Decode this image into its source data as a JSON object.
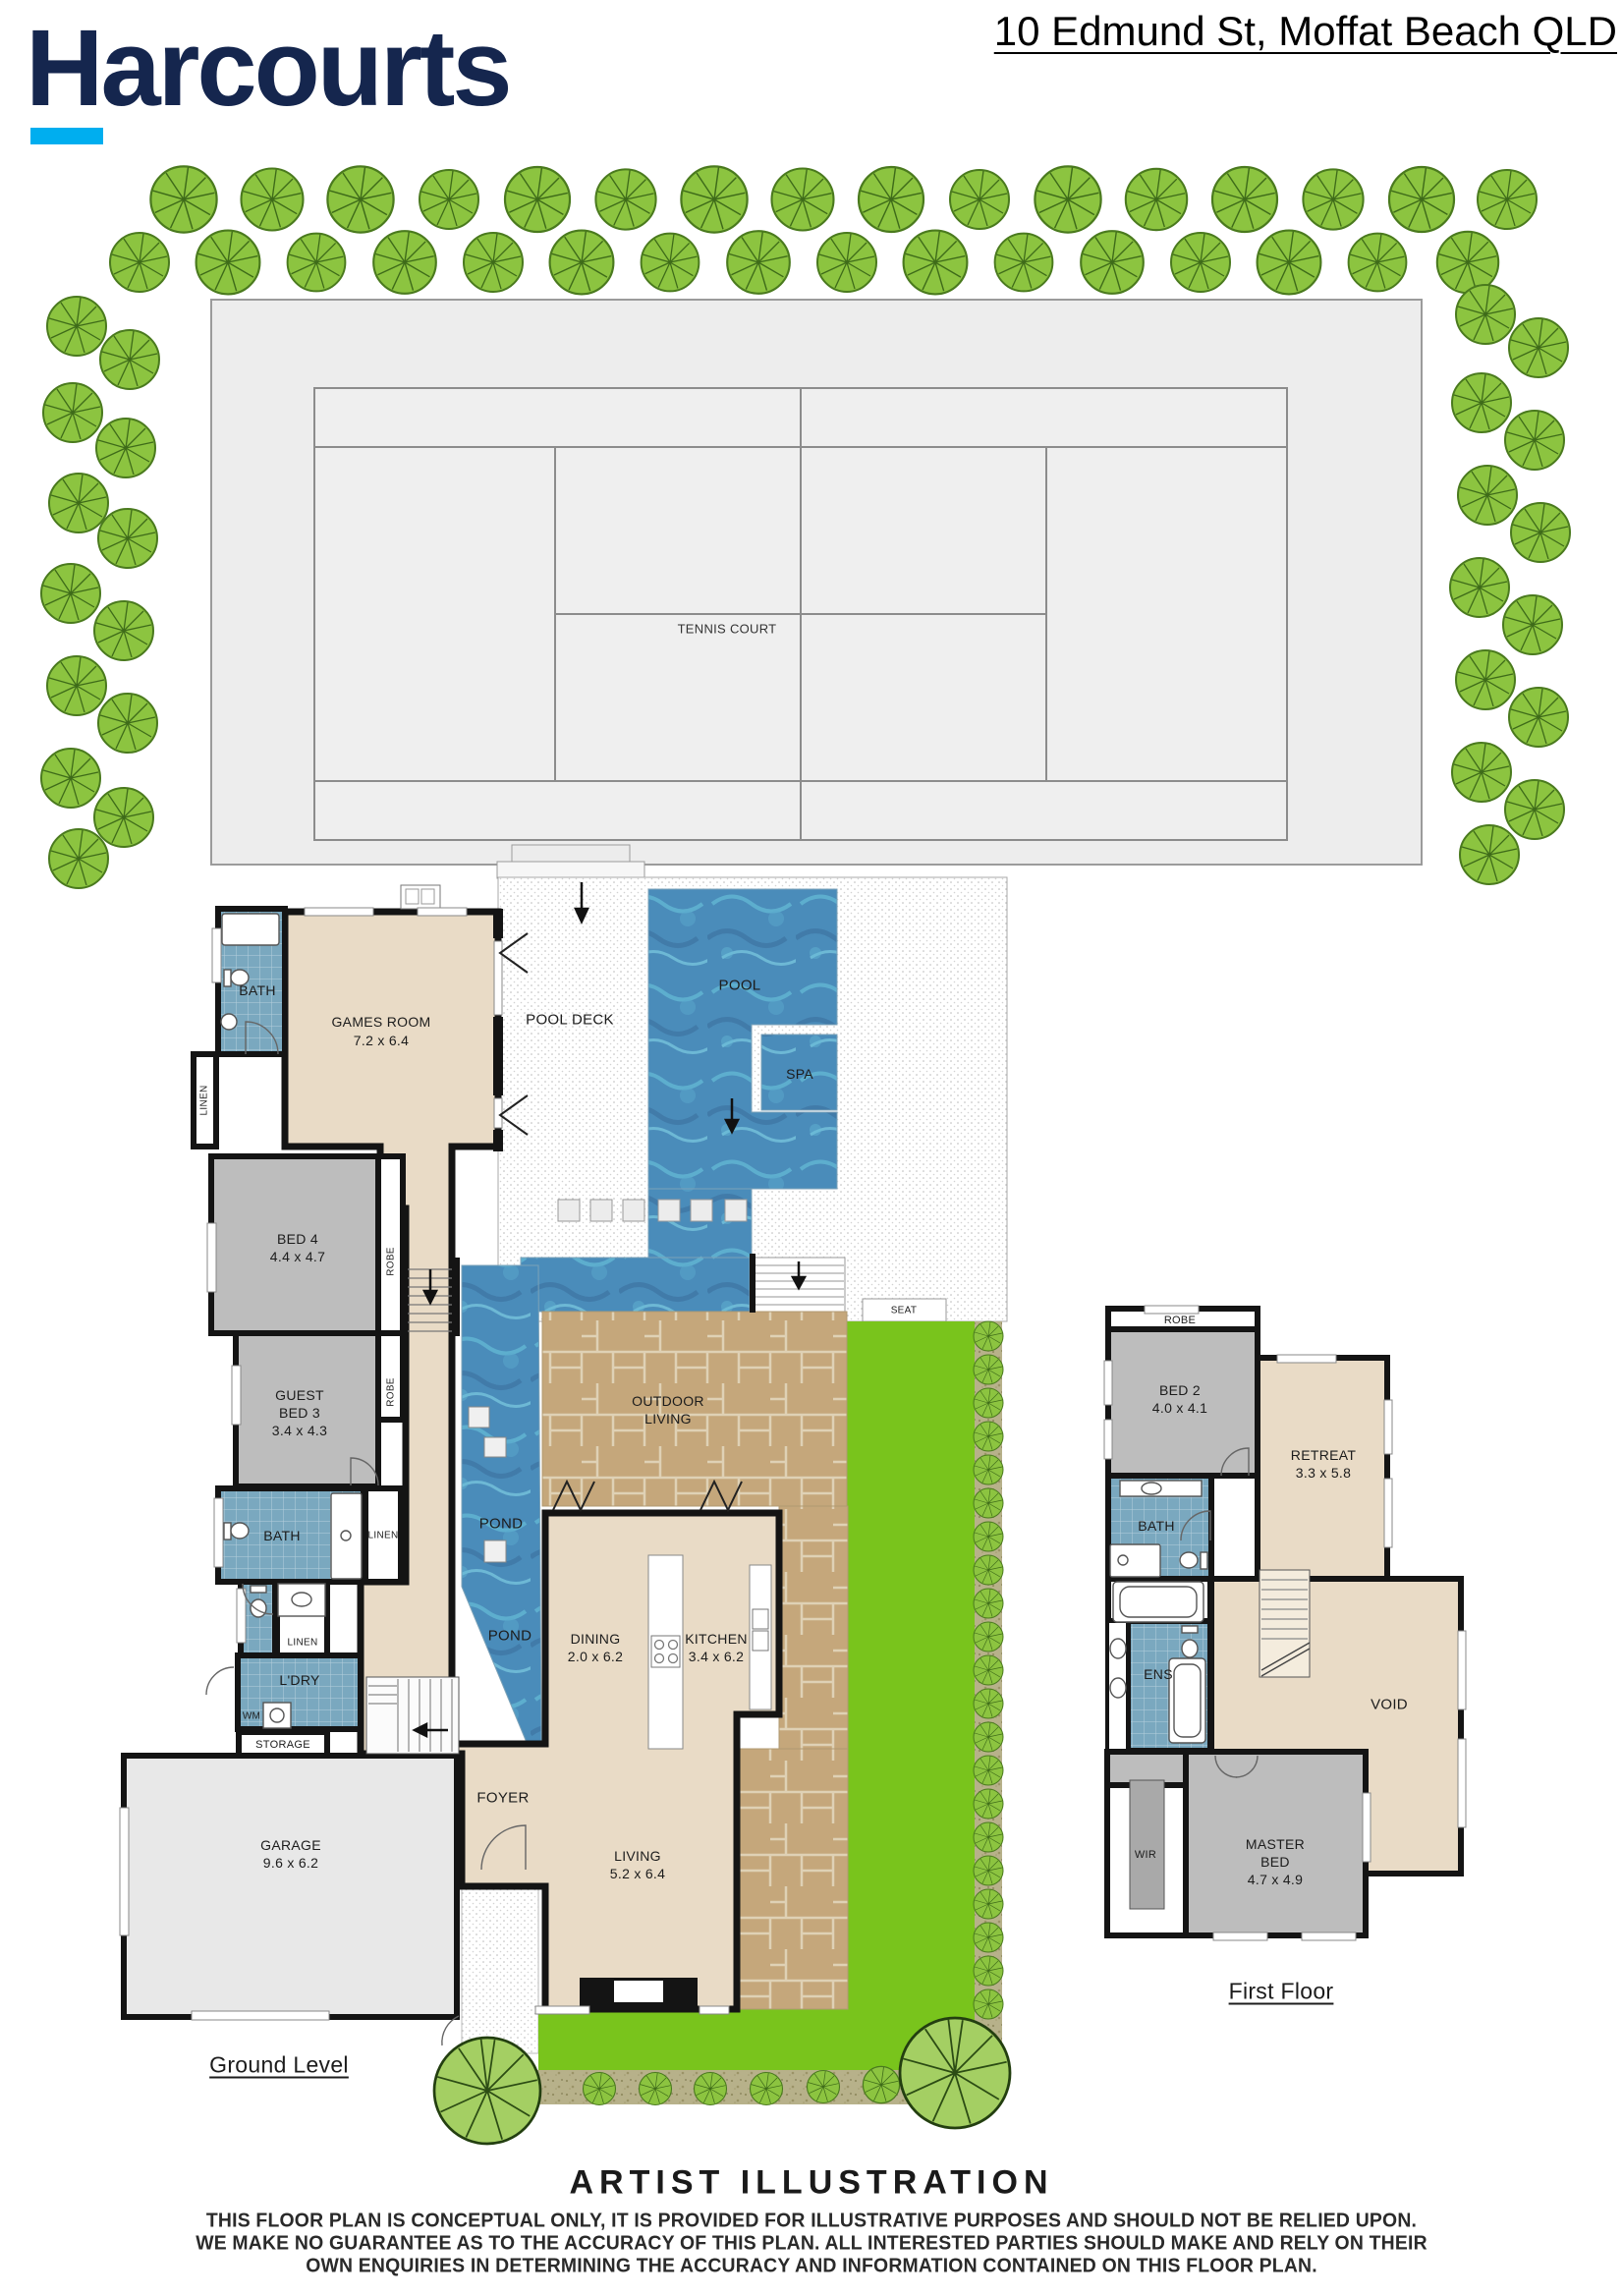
{
  "header": {
    "brand": "Harcourts",
    "address": "10 Edmund St, Moffat Beach QLD"
  },
  "site": {
    "tennis_court": "TENNIS COURT",
    "pool_deck": "POOL DECK",
    "pool": "POOL",
    "spa": "SPA",
    "seat": "SEAT"
  },
  "ground": {
    "caption": "Ground Level",
    "bath1": "BATH",
    "games_name": "GAMES ROOM",
    "games_dims": "7.2 x 6.4",
    "linen1": "LINEN",
    "bed4_name": "BED 4",
    "bed4_dims": "4.4 x 4.7",
    "robe1": "ROBE",
    "guest_l1": "GUEST",
    "guest_l2": "BED 3",
    "guest_dims": "3.4 x 4.3",
    "robe2": "ROBE",
    "bath2": "BATH",
    "linen2": "LINEN",
    "linen3": "LINEN",
    "ldry": "L'DRY",
    "wm": "WM",
    "storage": "STORAGE",
    "garage_name": "GARAGE",
    "garage_dims": "9.6 x 6.2",
    "foyer": "FOYER",
    "dining_name": "DINING",
    "dining_dims": "2.0 x 6.2",
    "kitchen_name": "KITCHEN",
    "kitchen_dims": "3.4 x 6.2",
    "living_name": "LIVING",
    "living_dims": "5.2 x 6.4",
    "outdoor_l1": "OUTDOOR",
    "outdoor_l2": "LIVING",
    "pond1": "POND",
    "pond2": "POND"
  },
  "first": {
    "caption": "First Floor",
    "robe": "ROBE",
    "bed2_name": "BED 2",
    "bed2_dims": "4.0 x 4.1",
    "retreat_name": "RETREAT",
    "retreat_dims": "3.3 x 5.8",
    "bath": "BATH",
    "ens": "ENS",
    "void": "VOID",
    "wir": "WIR",
    "master_l1": "MASTER",
    "master_l2": "BED",
    "master_dims": "4.7 x 4.9"
  },
  "footer": {
    "title": "ARTIST ILLUSTRATION",
    "line1": "THIS FLOOR PLAN IS CONCEPTUAL ONLY, IT IS PROVIDED FOR ILLUSTRATIVE PURPOSES AND SHOULD NOT BE RELIED UPON.",
    "line2": "WE MAKE NO GUARANTEE AS TO THE ACCURACY OF THIS PLAN. ALL INTERESTED PARTIES SHOULD MAKE AND RELY ON THEIR",
    "line3": "OWN ENQUIRIES IN DETERMINING THE ACCURACY AND INFORMATION CONTAINED ON THIS FLOOR PLAN."
  },
  "colors": {
    "brand_navy": "#15264e",
    "brand_cyan": "#00aeef",
    "water": "#4a8cba",
    "grass": "#79c41c",
    "beige": "#e9dbc6",
    "room_gray": "#bdbdbd",
    "tile_teal": "#7aa8bf",
    "paver_tan": "#c9aa7d"
  }
}
